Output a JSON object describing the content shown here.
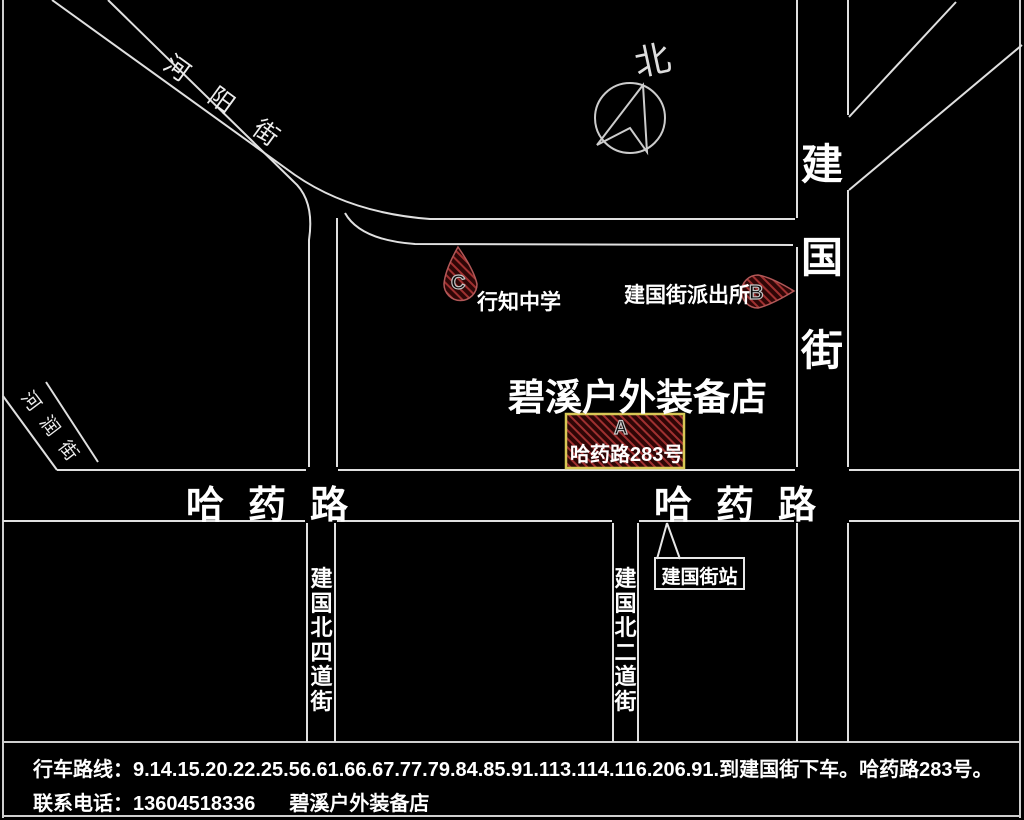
{
  "compass": {
    "label": "北"
  },
  "streets": {
    "heyang": "河阳街",
    "herun": "河润街",
    "jianguo_vertical": "建国街",
    "hayao_west": "哈药路",
    "hayao_east": "哈药路",
    "jianguo_north_4th": "建国北四道街",
    "jianguo_north_2nd": "建国北二道街"
  },
  "markers": {
    "a": {
      "letter": "A",
      "address": "哈药路283号"
    },
    "b": {
      "letter": "B",
      "label": "建国街派出所"
    },
    "c": {
      "letter": "C",
      "label": "行知中学"
    }
  },
  "store": {
    "name": "碧溪户外装备店"
  },
  "bus_stop": {
    "label": "建国街站"
  },
  "footer": {
    "route": "行车路线：9.14.15.20.22.25.56.61.66.67.77.79.84.85.91.113.114.116.206.91.到建国街下车。哈药路283号。",
    "phone": "联系电话：13604518336",
    "store": "碧溪户外装备店"
  },
  "colors": {
    "background": "#000000",
    "road_line": "#e0e0e0",
    "text": "#ffffff",
    "marker_fill": "#2e0606",
    "marker_hatch": "#a03030",
    "marker_outline": "#b25858",
    "address_box_border": "#d8c855"
  }
}
